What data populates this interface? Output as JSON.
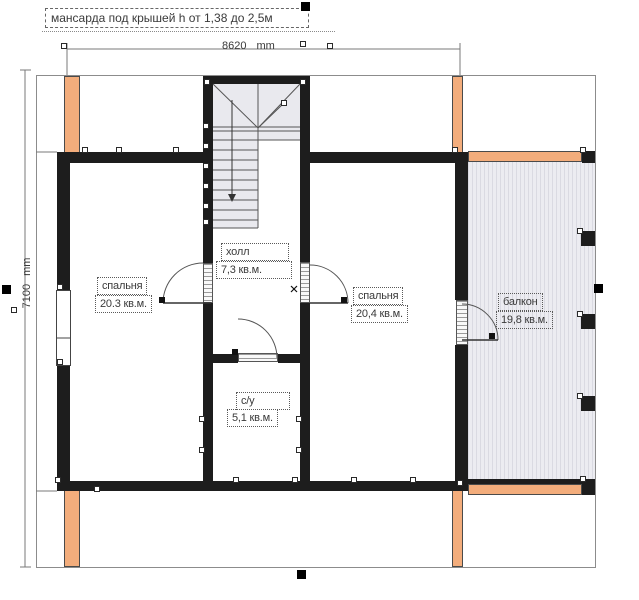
{
  "title": "мансарда под крышей h от 1,38 до 2,5м",
  "dimensions": {
    "width_value": "8620",
    "width_unit": "mm",
    "height_value": "7100",
    "height_unit": "mm"
  },
  "rooms": {
    "bedroom_left": {
      "name": "спальня",
      "area": "20.3 кв.м."
    },
    "hall": {
      "name": "холл",
      "area": "7,3 кв.м."
    },
    "bedroom_right": {
      "name": "спальня",
      "area": "20,4 кв.м."
    },
    "balcony": {
      "name": "балкон",
      "area": "19,8 кв.м."
    },
    "bathroom": {
      "name": "с/у",
      "area": "5,1 кв.м."
    }
  },
  "colors": {
    "wall": "#1d1d1d",
    "post": "#f3ad7c",
    "balcony_fill": "#ececf1",
    "stairs_fill": "#e9e9ee"
  }
}
